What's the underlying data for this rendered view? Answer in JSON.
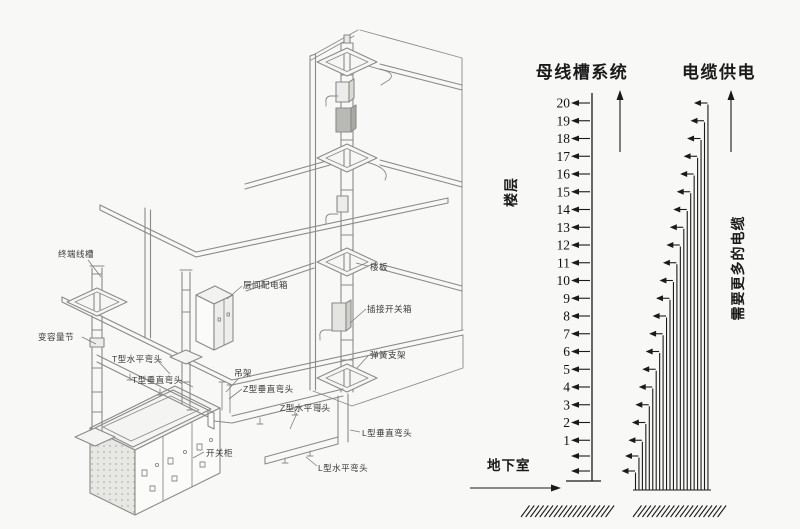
{
  "comparison": {
    "busway_title": "母线槽系统",
    "cable_title": "电缆供电",
    "floor_axis_label": "楼层",
    "cable_note_label": "需要更多的电缆",
    "basement_label": "地下室",
    "floors": [
      "20",
      "19",
      "18",
      "17",
      "16",
      "15",
      "14",
      "13",
      "12",
      "11",
      "10",
      "9",
      "8",
      "7",
      "6",
      "5",
      "4",
      "3",
      "2",
      "1"
    ],
    "basement_arrow_rows": 2,
    "cable_count": 22,
    "arrow_color": "#1a1a1a"
  },
  "diagram": {
    "labels": [
      {
        "id": "terminal-trunking",
        "text": "终端线槽"
      },
      {
        "id": "capacity-change-section",
        "text": "变容量节"
      },
      {
        "id": "t-horizontal-elbow",
        "text": "T型水平弯头"
      },
      {
        "id": "t-vertical-elbow",
        "text": "T型垂直弯头"
      },
      {
        "id": "hanger",
        "text": "吊架"
      },
      {
        "id": "z-vertical-elbow",
        "text": "Z型垂直弯头"
      },
      {
        "id": "z-horizontal-elbow",
        "text": "Z型水平弯头"
      },
      {
        "id": "l-vertical-elbow",
        "text": "L型垂直弯头"
      },
      {
        "id": "l-horizontal-elbow",
        "text": "L型水平弯头"
      },
      {
        "id": "switch-cabinet",
        "text": "开关柜"
      },
      {
        "id": "interfloor-distribution-box",
        "text": "层间配电箱"
      },
      {
        "id": "floor-slab",
        "text": "楼板"
      },
      {
        "id": "plug-in-switch-box",
        "text": "插接开关箱"
      },
      {
        "id": "spring-bracket",
        "text": "弹簧支架"
      }
    ]
  },
  "colors": {
    "background": "#f8f8f6",
    "line_art": "#8a8a8a",
    "chart_ink": "#1a1a1a"
  }
}
